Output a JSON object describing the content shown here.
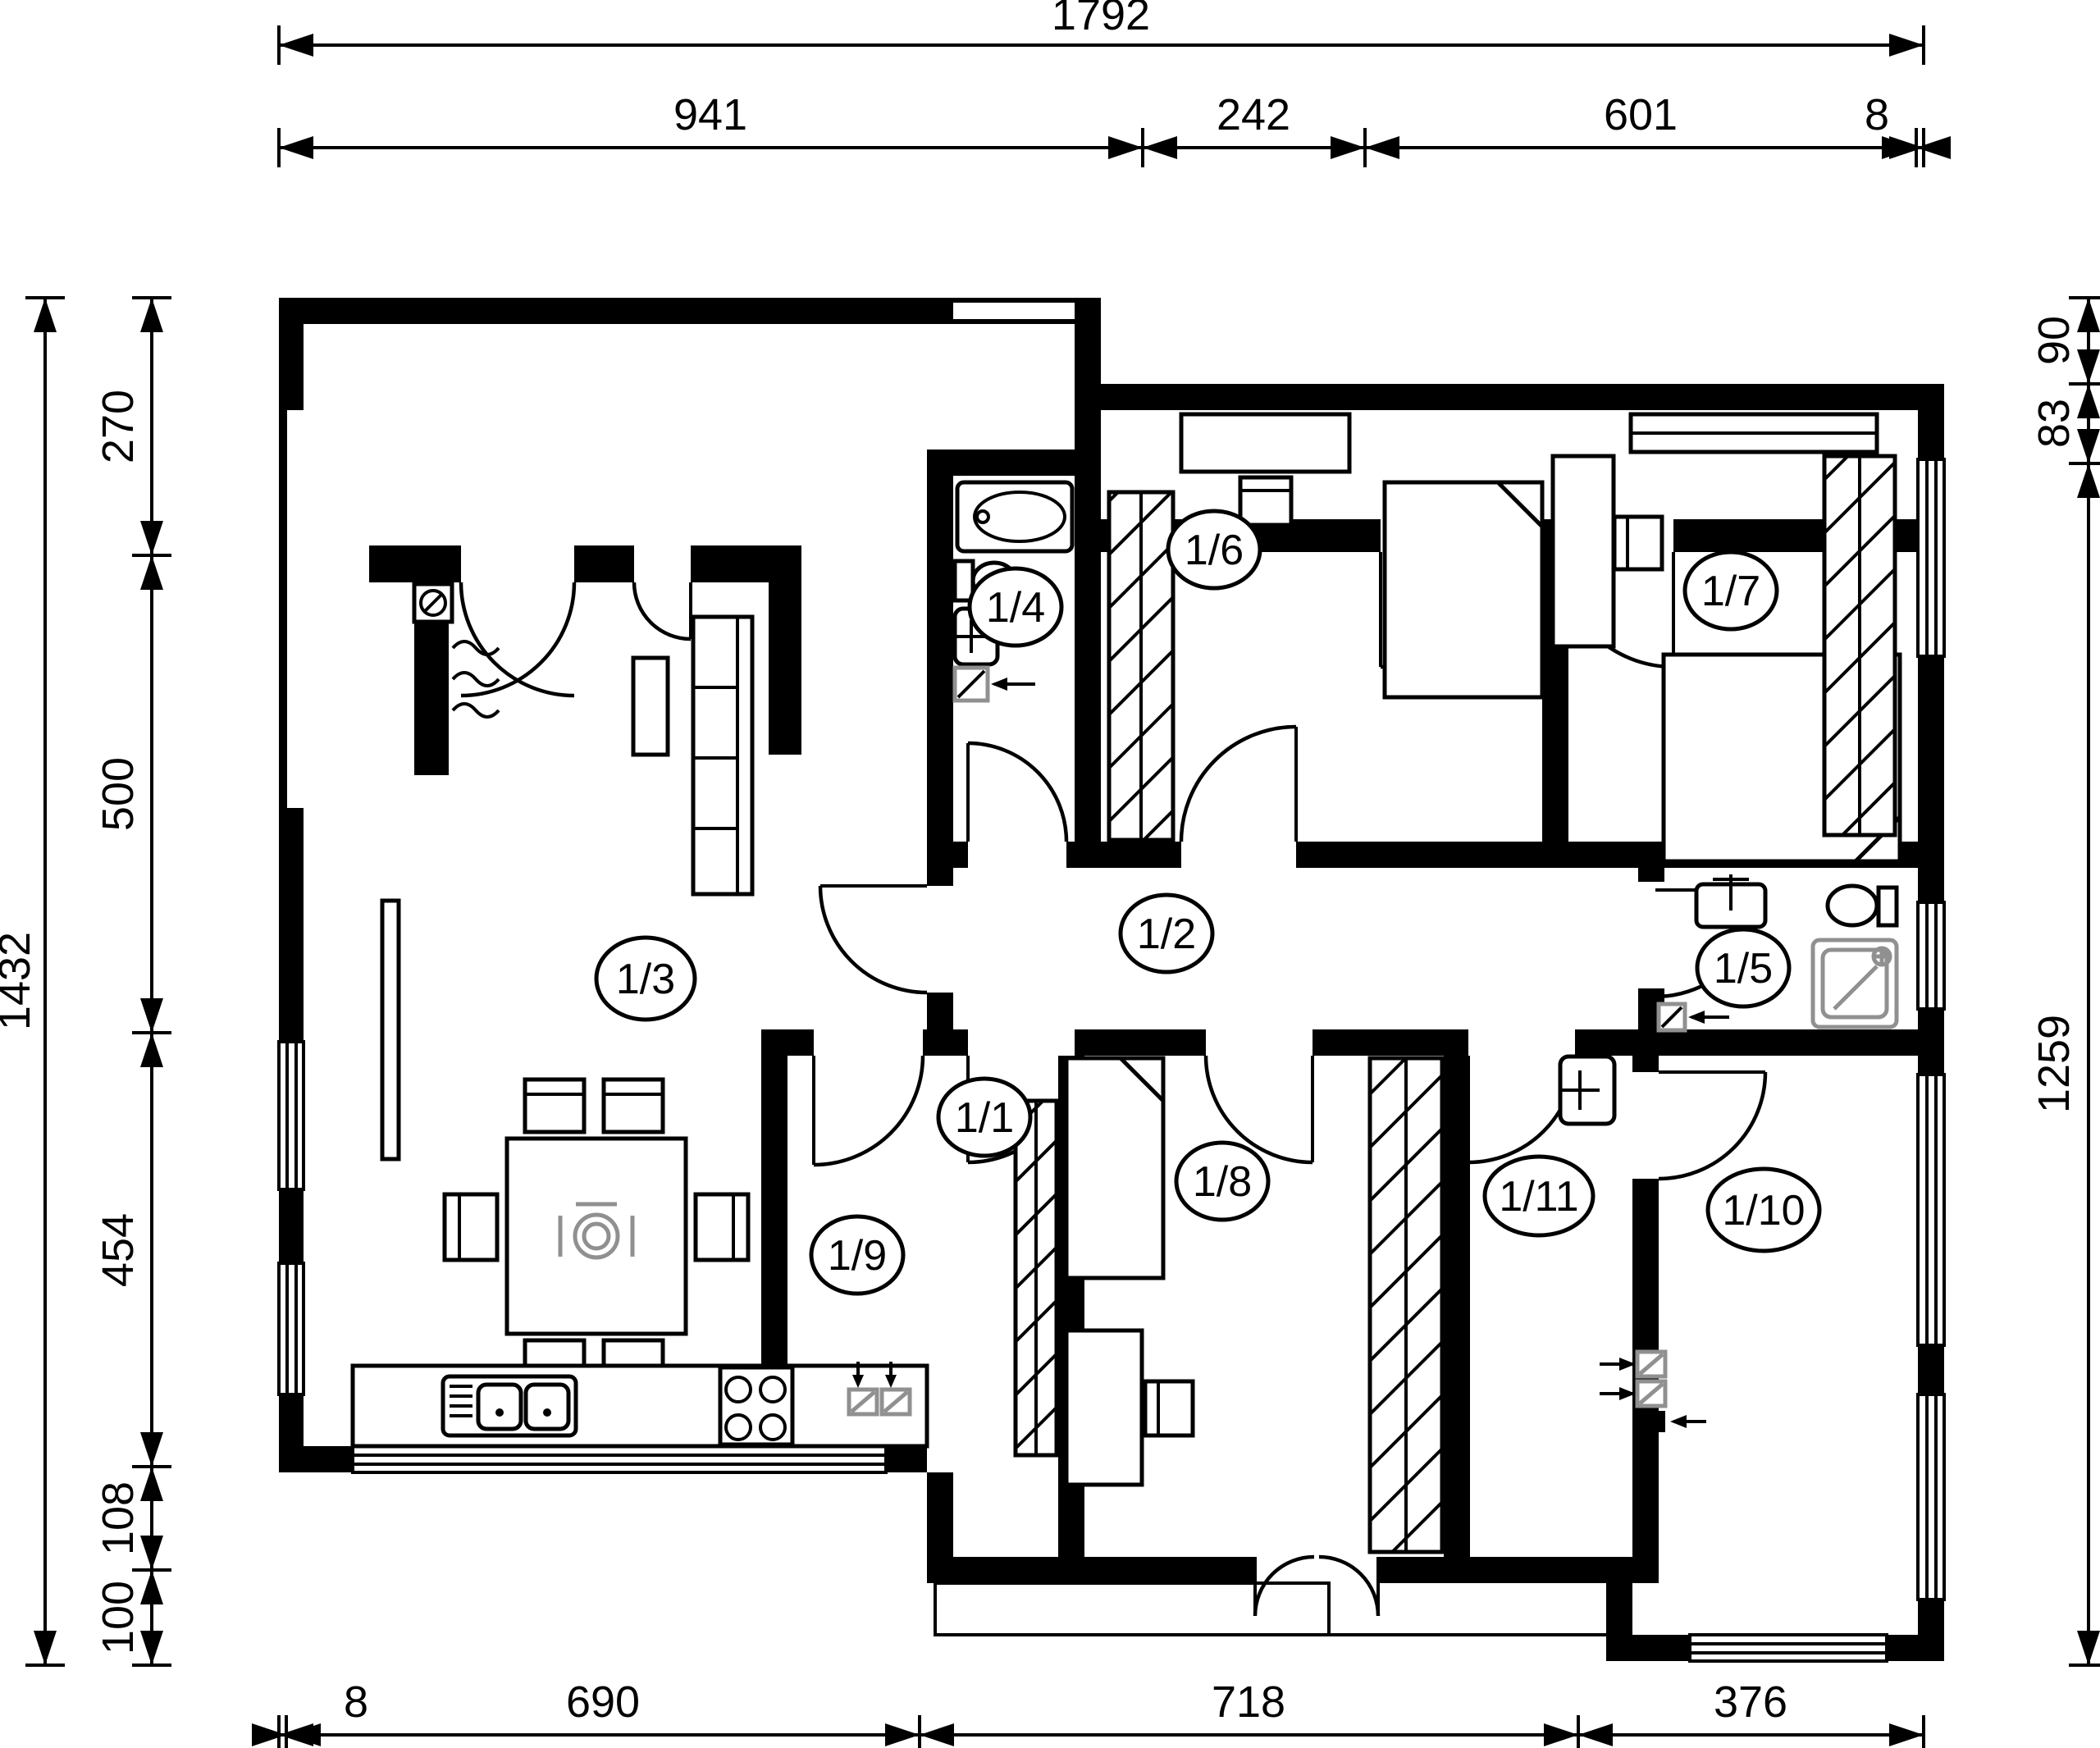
{
  "dims": {
    "top_total": "1792",
    "top": [
      "941",
      "242",
      "601",
      "8"
    ],
    "left_total": "1432",
    "left": [
      "270",
      "500",
      "454",
      "108",
      "100"
    ],
    "right": [
      "90",
      "83",
      "1259"
    ],
    "bottom": [
      "8",
      "690",
      "718",
      "376"
    ]
  },
  "rooms": [
    "1/1",
    "1/2",
    "1/3",
    "1/4",
    "1/5",
    "1/6",
    "1/7",
    "1/8",
    "1/9",
    "1/10",
    "1/11"
  ],
  "colors": {
    "wall": "#000000",
    "background": "#ffffff",
    "fixture_gray": "#909090"
  }
}
